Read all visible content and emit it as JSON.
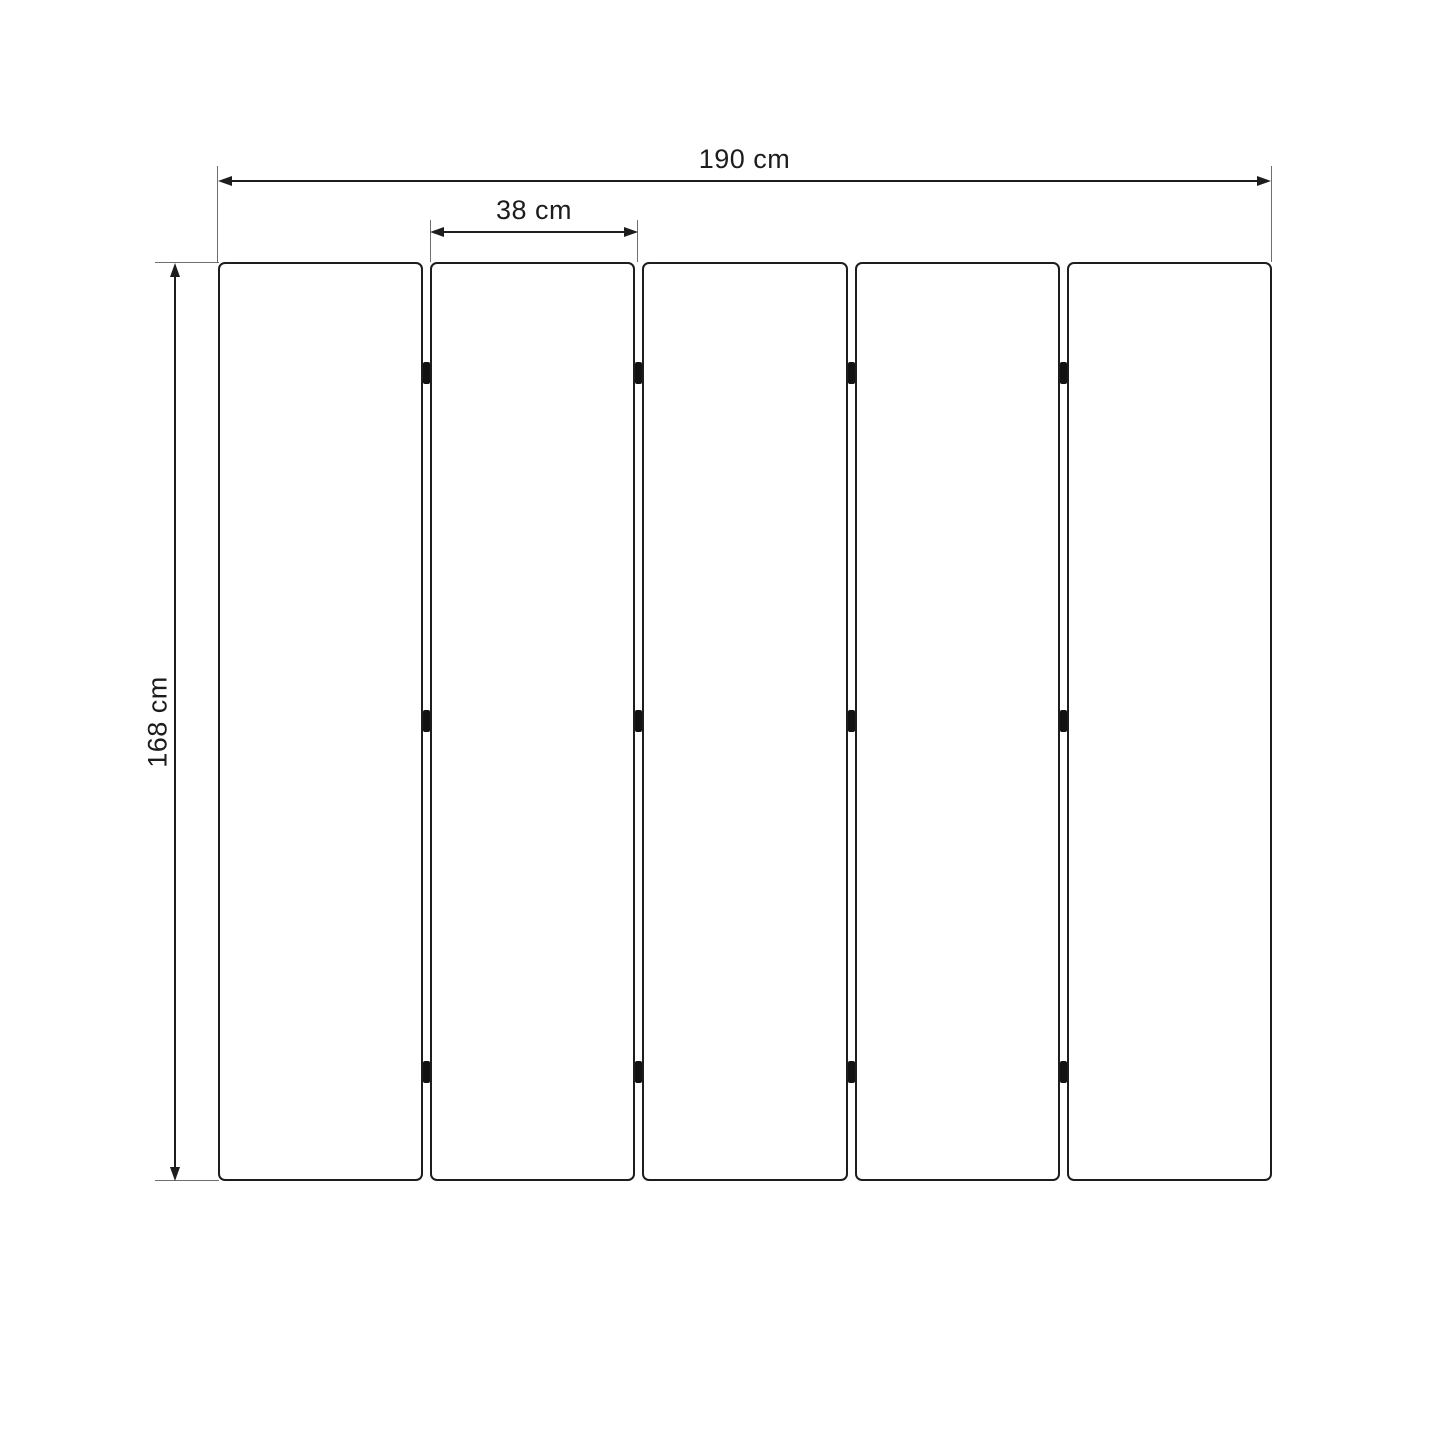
{
  "diagram": {
    "type": "panel-dimension-drawing",
    "dimensions": {
      "total_width": {
        "label": "190 cm",
        "value_cm": 190
      },
      "panel_width": {
        "label": "38 cm",
        "value_cm": 38
      },
      "height": {
        "label": "168 cm",
        "value_cm": 168
      }
    },
    "panels": {
      "count": 5,
      "hinge_columns": 4,
      "hinge_rows": 3
    },
    "colors": {
      "line": "#1d1d1d",
      "extension": "#6e6e6e",
      "hinge": "#121212",
      "text": "#1c1c1c",
      "background": "#ffffff",
      "panel_fill": "#ffffff"
    }
  }
}
